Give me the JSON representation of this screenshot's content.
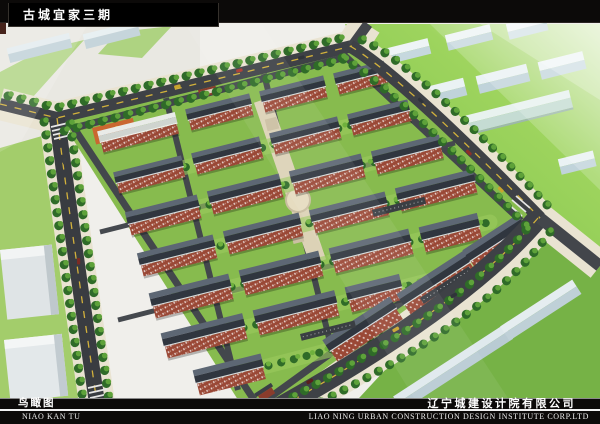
{
  "header": {
    "project_title": "古城宜家三期"
  },
  "footer": {
    "view_label_cn": "鸟瞰图",
    "view_label_en": "NIAO KAN TU",
    "company_cn": "辽宁城建设计院有限公司",
    "company_en": "LIAO NING URBAN CONSTRUCTION DESIGN INSTITUTE CORP.LTD"
  },
  "palette": {
    "band_black": "#0c0a09",
    "title_text": "#ffffff",
    "divider_white": "#f2f2f2",
    "background": "#f2f1ed",
    "road_asphalt": "#3e4146",
    "lane_dash_yellow": "#d2b13c",
    "sidewalk_beige": "#e9e3d1",
    "site_lawn_green": "#87bb4e",
    "outer_lawn_green": "#9ccb60",
    "tree_green_dark": "#2f6b28",
    "tree_green_light": "#5ea23a",
    "brick_red": "#9a4836",
    "roof_slate_dark": "#30363f",
    "roof_slate_light": "#5d6774",
    "context_building_blue": "#c9dbe2",
    "plaza_beige": "#dcd2b6",
    "playground_orange": "#cf5f2e"
  }
}
